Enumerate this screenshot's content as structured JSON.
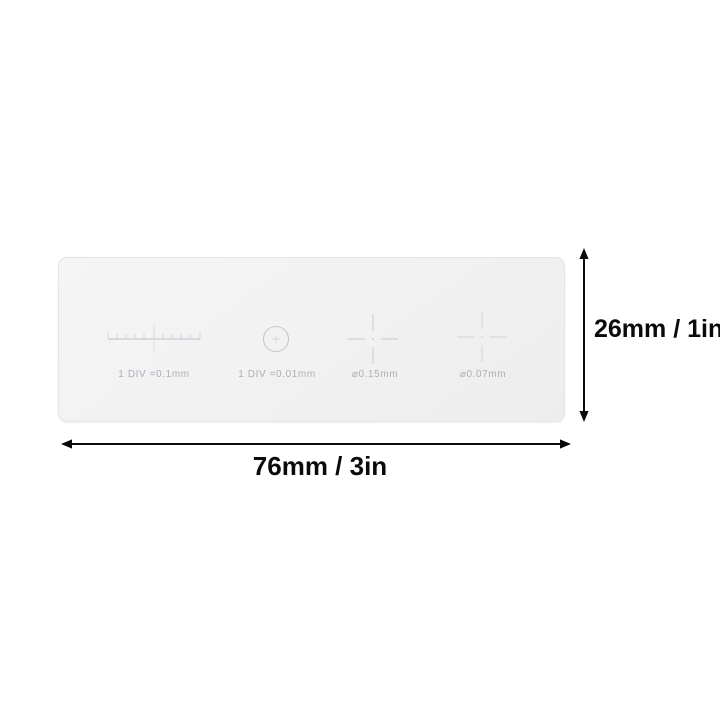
{
  "scene": {
    "type": "product-dimension-diagram",
    "subject": "microscope stage calibration slide"
  },
  "slide": {
    "markings": [
      {
        "name": "stage-micrometer-ruler",
        "label": "1 DIV =0.1mm"
      },
      {
        "name": "circle-reticle",
        "label": "1 DIV =0.01mm"
      },
      {
        "name": "crosshair-reticle-015",
        "label": "⌀0.15mm"
      },
      {
        "name": "crosshair-reticle-007",
        "label": "⌀0.07mm"
      }
    ]
  },
  "dimension_annotations": {
    "height_label": "26mm  /  1in",
    "width_label": "76mm  /  3in"
  },
  "colors": {
    "background": "#ffffff",
    "slide_fill": "#f1f1f2",
    "slide_border": "#e4e5e6",
    "marking_stroke": "#c9cdcf",
    "marking_text": "#aab0b3",
    "annotation_ink": "#0b0b0b"
  }
}
